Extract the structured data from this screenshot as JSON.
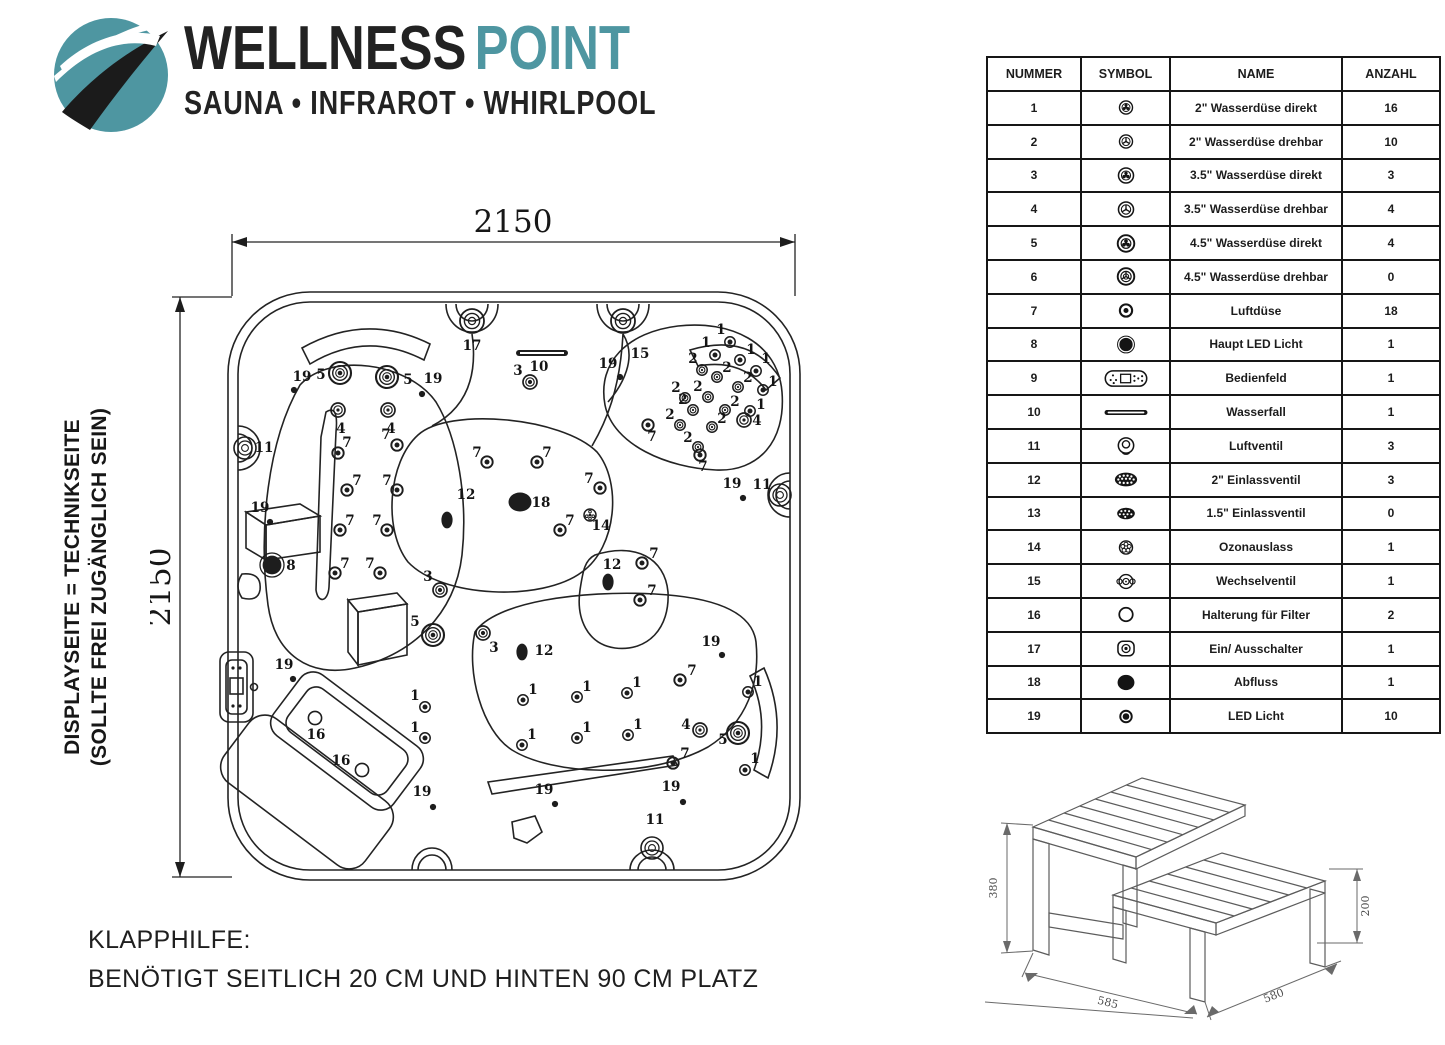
{
  "logo": {
    "brand_primary": "WELLNESS",
    "brand_secondary": "POINT",
    "subtitle": "SAUNA • INFRAROT • WHIRLPOOL",
    "teal": "#4e96a1"
  },
  "side_note": {
    "line1": "DISPLAYSEITE = TECHNIKSEITE",
    "line2": "(SOLLTE FREI ZUGÄNGLICH SEIN)"
  },
  "dimensions": {
    "top": "2150",
    "left": "2150"
  },
  "klapphilfe": {
    "line1": "KLAPPHILFE:",
    "line2": "BENÖTIGT SEITLICH 20 CM UND HINTEN 90 CM PLATZ"
  },
  "table": {
    "headers": [
      "NUMMER",
      "SYMBOL",
      "NAME",
      "ANZAHL"
    ],
    "rows": [
      {
        "nummer": "1",
        "symbol": "wd2-direkt",
        "name": "2\" Wasserdüse direkt",
        "anzahl": "16"
      },
      {
        "nummer": "2",
        "symbol": "wd2-drehbar",
        "name": "2\" Wasserdüse drehbar",
        "anzahl": "10"
      },
      {
        "nummer": "3",
        "symbol": "wd35-direkt",
        "name": "3.5\" Wasserdüse direkt",
        "anzahl": "3"
      },
      {
        "nummer": "4",
        "symbol": "wd35-drehbar",
        "name": "3.5\" Wasserdüse drehbar",
        "anzahl": "4"
      },
      {
        "nummer": "5",
        "symbol": "wd45-direkt",
        "name": "4.5\" Wasserdüse direkt",
        "anzahl": "4"
      },
      {
        "nummer": "6",
        "symbol": "wd45-drehbar",
        "name": "4.5\" Wasserdüse drehbar",
        "anzahl": "0"
      },
      {
        "nummer": "7",
        "symbol": "luftduese",
        "name": "Luftdüse",
        "anzahl": "18"
      },
      {
        "nummer": "8",
        "symbol": "haupt-led",
        "name": "Haupt LED Licht",
        "anzahl": "1"
      },
      {
        "nummer": "9",
        "symbol": "bedienfeld",
        "name": "Bedienfeld",
        "anzahl": "1"
      },
      {
        "nummer": "10",
        "symbol": "wasserfall",
        "name": "Wasserfall",
        "anzahl": "1"
      },
      {
        "nummer": "11",
        "symbol": "luftventil",
        "name": "Luftventil",
        "anzahl": "3"
      },
      {
        "nummer": "12",
        "symbol": "einlass2",
        "name": "2\" Einlassventil",
        "anzahl": "3"
      },
      {
        "nummer": "13",
        "symbol": "einlass15",
        "name": "1.5\" Einlassventil",
        "anzahl": "0"
      },
      {
        "nummer": "14",
        "symbol": "ozon",
        "name": "Ozonauslass",
        "anzahl": "1"
      },
      {
        "nummer": "15",
        "symbol": "wechsel",
        "name": "Wechselventil",
        "anzahl": "1"
      },
      {
        "nummer": "16",
        "symbol": "filterhalter",
        "name": "Halterung für Filter",
        "anzahl": "2"
      },
      {
        "nummer": "17",
        "symbol": "einaus",
        "name": "Ein/ Ausschalter",
        "anzahl": "1"
      },
      {
        "nummer": "18",
        "symbol": "abfluss",
        "name": "Abfluss",
        "anzahl": "1"
      },
      {
        "nummer": "19",
        "symbol": "ledlicht",
        "name": "LED Licht",
        "anzahl": "10"
      }
    ]
  },
  "tub": {
    "markers": [
      {
        "n": "19",
        "x": 144,
        "y": 190,
        "lx": 152,
        "ly": 181
      },
      {
        "n": "19",
        "x": 272,
        "y": 194,
        "lx": 283,
        "ly": 183
      },
      {
        "n": "19",
        "x": 470,
        "y": 177,
        "lx": 458,
        "ly": 168
      },
      {
        "n": "19",
        "x": 593,
        "y": 298,
        "lx": 582,
        "ly": 288
      },
      {
        "n": "19",
        "x": 120,
        "y": 322,
        "lx": 110,
        "ly": 312
      },
      {
        "n": "19",
        "x": 143,
        "y": 479,
        "lx": 134,
        "ly": 469
      },
      {
        "n": "19",
        "x": 283,
        "y": 607,
        "lx": 272,
        "ly": 596
      },
      {
        "n": "19",
        "x": 405,
        "y": 604,
        "lx": 394,
        "ly": 594
      },
      {
        "n": "19",
        "x": 533,
        "y": 602,
        "lx": 521,
        "ly": 591
      },
      {
        "n": "19",
        "x": 572,
        "y": 455,
        "lx": 561,
        "ly": 446
      },
      {
        "n": "5",
        "x": 190,
        "y": 173,
        "lx": 171,
        "ly": 179
      },
      {
        "n": "5",
        "x": 237,
        "y": 177,
        "lx": 258,
        "ly": 184
      },
      {
        "n": "5",
        "x": 283,
        "y": 435,
        "lx": 265,
        "ly": 426
      },
      {
        "n": "5",
        "x": 588,
        "y": 533,
        "lx": 573,
        "ly": 544
      },
      {
        "n": "4",
        "x": 188,
        "y": 210,
        "lx": 191,
        "ly": 233
      },
      {
        "n": "4",
        "x": 238,
        "y": 210,
        "lx": 241,
        "ly": 233
      },
      {
        "n": "4",
        "x": 594,
        "y": 220,
        "lx": 607,
        "ly": 225
      },
      {
        "n": "4",
        "x": 550,
        "y": 530,
        "lx": 536,
        "ly": 529
      },
      {
        "n": "3",
        "x": 380,
        "y": 182,
        "lx": 368,
        "ly": 175
      },
      {
        "n": "3",
        "x": 290,
        "y": 390,
        "lx": 278,
        "ly": 381
      },
      {
        "n": "3",
        "x": 333,
        "y": 433,
        "lx": 344,
        "ly": 452
      },
      {
        "n": "17",
        "x": 322,
        "y": 121,
        "lx": 322,
        "ly": 150
      },
      {
        "n": "15",
        "x": 473,
        "y": 121,
        "lx": 490,
        "ly": 158
      },
      {
        "n": "10",
        "lx": 389,
        "ly": 171
      },
      {
        "n": "11",
        "x": 95,
        "y": 248,
        "lx": 114,
        "ly": 252
      },
      {
        "n": "11",
        "x": 630,
        "y": 295,
        "lx": 612,
        "ly": 289
      },
      {
        "n": "11",
        "x": 502,
        "y": 648,
        "lx": 505,
        "ly": 624
      },
      {
        "n": "8",
        "x": 122,
        "y": 365,
        "lx": 141,
        "ly": 370
      },
      {
        "n": "18",
        "x": 370,
        "y": 302,
        "lx": 391,
        "ly": 307
      },
      {
        "n": "14",
        "x": 440,
        "y": 315,
        "lx": 451,
        "ly": 330
      },
      {
        "n": "12",
        "x": 297,
        "y": 320,
        "lx": 316,
        "ly": 299
      },
      {
        "n": "12",
        "x": 458,
        "y": 382,
        "lx": 462,
        "ly": 369
      },
      {
        "n": "12",
        "x": 372,
        "y": 452,
        "lx": 394,
        "ly": 455
      },
      {
        "n": "16",
        "x": 165,
        "y": 518,
        "lx": 166,
        "ly": 539
      },
      {
        "n": "16",
        "x": 212,
        "y": 570,
        "lx": 191,
        "ly": 565
      },
      {
        "n": "1",
        "x": 565,
        "y": 155,
        "lx": 556,
        "ly": 147
      },
      {
        "n": "1",
        "x": 590,
        "y": 160,
        "lx": 601,
        "ly": 154
      },
      {
        "n": "1",
        "x": 606,
        "y": 171,
        "lx": 616,
        "ly": 163
      },
      {
        "n": "1",
        "x": 613,
        "y": 190,
        "lx": 623,
        "ly": 186
      },
      {
        "n": "1",
        "x": 600,
        "y": 211,
        "lx": 611,
        "ly": 209
      },
      {
        "n": "1",
        "x": 580,
        "y": 142,
        "lx": 571,
        "ly": 134
      },
      {
        "n": "2",
        "x": 552,
        "y": 170,
        "lx": 543,
        "ly": 163
      },
      {
        "n": "2",
        "x": 567,
        "y": 177,
        "lx": 577,
        "ly": 172
      },
      {
        "n": "2",
        "x": 558,
        "y": 197,
        "lx": 548,
        "ly": 191
      },
      {
        "n": "2",
        "x": 588,
        "y": 187,
        "lx": 598,
        "ly": 182
      },
      {
        "n": "2",
        "x": 543,
        "y": 210,
        "lx": 533,
        "ly": 204
      },
      {
        "n": "2",
        "x": 575,
        "y": 210,
        "lx": 585,
        "ly": 206
      },
      {
        "n": "2",
        "x": 530,
        "y": 225,
        "lx": 520,
        "ly": 219
      },
      {
        "n": "2",
        "x": 562,
        "y": 227,
        "lx": 572,
        "ly": 223
      },
      {
        "n": "2",
        "x": 548,
        "y": 247,
        "lx": 538,
        "ly": 242
      },
      {
        "n": "2",
        "x": 535,
        "y": 198,
        "lx": 526,
        "ly": 192
      },
      {
        "n": "7",
        "x": 188,
        "y": 253,
        "lx": 197,
        "ly": 247
      },
      {
        "n": "7",
        "x": 247,
        "y": 245,
        "lx": 236,
        "ly": 239
      },
      {
        "n": "7",
        "x": 197,
        "y": 290,
        "lx": 207,
        "ly": 285
      },
      {
        "n": "7",
        "x": 247,
        "y": 290,
        "lx": 237,
        "ly": 285
      },
      {
        "n": "7",
        "x": 190,
        "y": 330,
        "lx": 200,
        "ly": 325
      },
      {
        "n": "7",
        "x": 237,
        "y": 330,
        "lx": 227,
        "ly": 325
      },
      {
        "n": "7",
        "x": 185,
        "y": 373,
        "lx": 195,
        "ly": 368
      },
      {
        "n": "7",
        "x": 230,
        "y": 373,
        "lx": 220,
        "ly": 368
      },
      {
        "n": "7",
        "x": 337,
        "y": 262,
        "lx": 327,
        "ly": 257
      },
      {
        "n": "7",
        "x": 387,
        "y": 262,
        "lx": 397,
        "ly": 257
      },
      {
        "n": "7",
        "x": 498,
        "y": 225,
        "lx": 502,
        "ly": 241
      },
      {
        "n": "7",
        "x": 550,
        "y": 255,
        "lx": 553,
        "ly": 271
      },
      {
        "n": "7",
        "x": 492,
        "y": 363,
        "lx": 504,
        "ly": 358
      },
      {
        "n": "7",
        "x": 490,
        "y": 400,
        "lx": 502,
        "ly": 395
      },
      {
        "n": "7",
        "x": 530,
        "y": 480,
        "lx": 542,
        "ly": 475
      },
      {
        "n": "7",
        "x": 523,
        "y": 563,
        "lx": 535,
        "ly": 558
      },
      {
        "n": "7",
        "x": 450,
        "y": 288,
        "lx": 439,
        "ly": 283
      },
      {
        "n": "7",
        "x": 410,
        "y": 330,
        "lx": 420,
        "ly": 325
      },
      {
        "n": "1",
        "x": 373,
        "y": 500,
        "lx": 383,
        "ly": 494
      },
      {
        "n": "1",
        "x": 427,
        "y": 497,
        "lx": 437,
        "ly": 491
      },
      {
        "n": "1",
        "x": 477,
        "y": 493,
        "lx": 487,
        "ly": 487
      },
      {
        "n": "1",
        "x": 372,
        "y": 545,
        "lx": 382,
        "ly": 539
      },
      {
        "n": "1",
        "x": 427,
        "y": 538,
        "lx": 437,
        "ly": 532
      },
      {
        "n": "1",
        "x": 478,
        "y": 535,
        "lx": 488,
        "ly": 529
      },
      {
        "n": "1",
        "x": 275,
        "y": 507,
        "lx": 265,
        "ly": 500
      },
      {
        "n": "1",
        "x": 275,
        "y": 538,
        "lx": 265,
        "ly": 532
      },
      {
        "n": "1",
        "x": 598,
        "y": 492,
        "lx": 608,
        "ly": 486
      },
      {
        "n": "1",
        "x": 595,
        "y": 570,
        "lx": 605,
        "ly": 563
      }
    ]
  },
  "steps": {
    "height": "380",
    "step_height": "200",
    "depth": "585",
    "width": "580"
  }
}
